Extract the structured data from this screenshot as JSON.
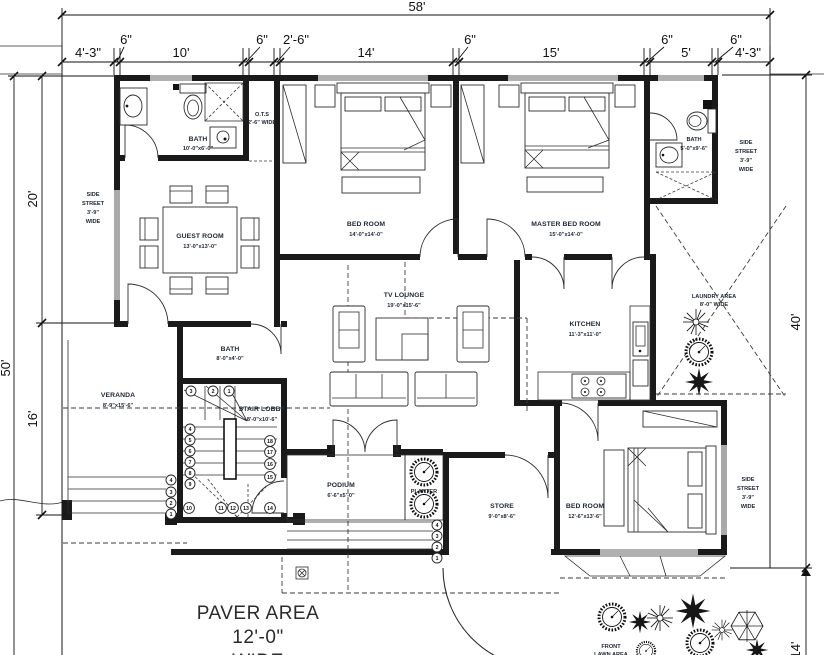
{
  "dims": {
    "top_total": "58'",
    "top_segments": [
      "4'-3\"",
      "6\"",
      "10'",
      "6\"",
      "2'-6\"",
      "14'",
      "6\"",
      "15'",
      "6\"",
      "5'",
      "6\"",
      "4'-3\""
    ],
    "left_total": "50'",
    "left_upper": "20'",
    "left_lower": "16'",
    "right_main": "40'",
    "right_lower": "14'"
  },
  "rooms": {
    "bath_top": {
      "name": "BATH",
      "size": "10'-0\"x6'-0\""
    },
    "ots": {
      "name": "O.T.S",
      "size": "2'-6\" WIDE"
    },
    "guest": {
      "name": "GUEST ROOM",
      "size": "13'-0\"x13'-0\""
    },
    "bedroom_top": {
      "name": "BED ROOM",
      "size": "14'-0\"x14'-0\""
    },
    "master": {
      "name": "MASTER BED ROOM",
      "size": "15'-0\"x14'-0\""
    },
    "bath_right": {
      "name": "BATH",
      "size": "5'-0\"x9'-6\""
    },
    "tv_lounge": {
      "name": "TV LOUNGE",
      "size": "19'-0\"x15'-6\""
    },
    "kitchen": {
      "name": "KITCHEN",
      "size": "11'-3\"x11'-0\""
    },
    "laundry": {
      "name": "LAUNDRY AREA",
      "size": "8'-0\" WIDE"
    },
    "veranda": {
      "name": "VERANDA",
      "size": "8'-9\"x15'-6\""
    },
    "bath_mid": {
      "name": "BATH",
      "size": "8'-0\"x4'-0\""
    },
    "stair_lobby": {
      "name": "STAIR LOBBY",
      "size": "8'-0\"x10'-6\""
    },
    "podium": {
      "name": "PODIUM",
      "size": "6'-6\"x5'-0\""
    },
    "planter": {
      "name": "PLANTER"
    },
    "store": {
      "name": "STORE",
      "size": "9'-0\"x8'-6\""
    },
    "bedroom_bottom": {
      "name": "BED ROOM",
      "size": "12'-6\"x13'-6\""
    }
  },
  "streets": {
    "left": {
      "lines": [
        "SIDE",
        "STREET",
        "3'-9\"",
        "WIDE"
      ]
    },
    "right_top": {
      "lines": [
        "SIDE",
        "STREET",
        "3'-9\"",
        "WIDE"
      ]
    },
    "right_bottom": {
      "lines": [
        "SIDE",
        "STREET",
        "3'-9\"",
        "WIDE"
      ]
    }
  },
  "areas": {
    "paver": {
      "lines": [
        "PAVER AREA",
        "12'-0\"",
        "WIDE"
      ]
    },
    "lawn": {
      "lines": [
        "FRONT",
        "LAWN AREA"
      ]
    }
  },
  "stairs": {
    "numbers": [
      "1",
      "2",
      "3",
      "4",
      "5",
      "6",
      "7",
      "8",
      "9",
      "10",
      "11",
      "12",
      "13",
      "14",
      "15",
      "16",
      "17",
      "18"
    ],
    "outside_steps": [
      "1",
      "2",
      "3",
      "4"
    ]
  }
}
